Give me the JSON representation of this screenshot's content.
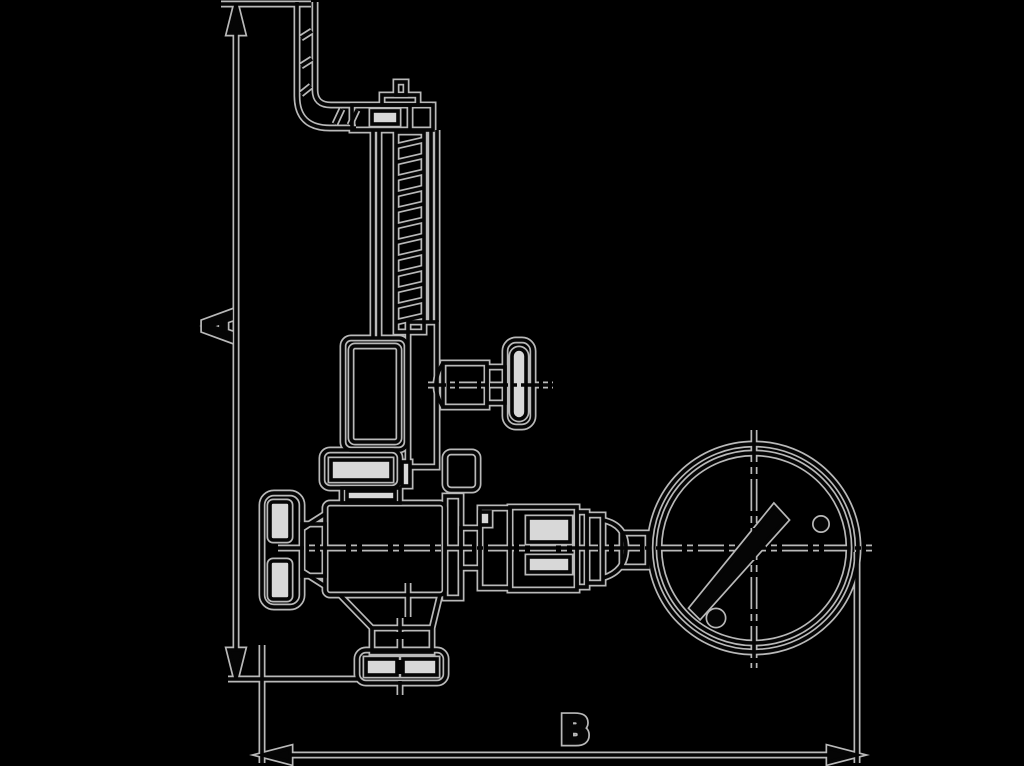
{
  "diagram": {
    "type": "technical-line-drawing",
    "subject": "safety relief valve with handwheel, test lever and pressure gauge - side elevation with overall dimensions",
    "background_color": "#000000",
    "halo_color": "#b9b9b9",
    "ink_color": "#050505",
    "slot_fill_color": "#d8d8d8",
    "dimensions": {
      "vertical_label": "A",
      "horizontal_label": "B"
    }
  }
}
